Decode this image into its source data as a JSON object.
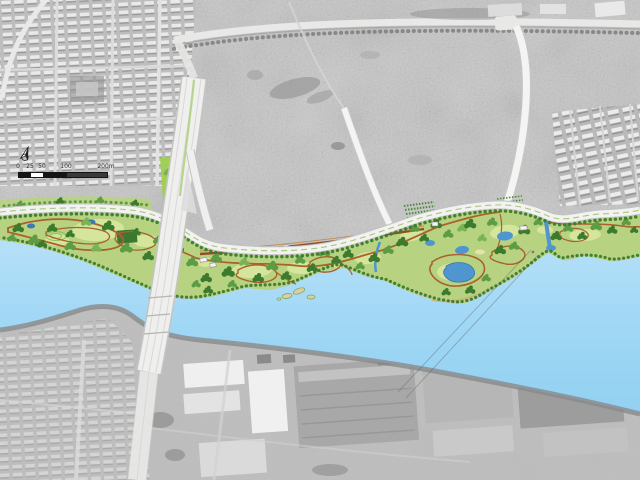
{
  "map": {
    "kind": "riverside-park-master-plan-over-aerial-photo"
  },
  "scale_bar": {
    "labels": [
      "0",
      "25",
      "50",
      "100",
      "200m"
    ]
  },
  "compass": {
    "icon": "north-arrow"
  },
  "colors": {
    "aerial_base": "#c6c6c6",
    "river_light": "#b6e0f8",
    "river_deep": "#93d0f1",
    "park_base": "#b7d381",
    "lawn": "#d6e59c",
    "tree_dark": "#3c7b2e",
    "tree_mid": "#5d9c45",
    "tree_light": "#79b355",
    "path": "#a9622c",
    "path_dark": "#8f4f26",
    "road_white": "#f2f2f0",
    "pond_blue": "#4f95cf",
    "island_tan": "#d9d0a2",
    "industrial_gray": "#a8a8a8",
    "shore_gray": "#8a8a8a"
  }
}
